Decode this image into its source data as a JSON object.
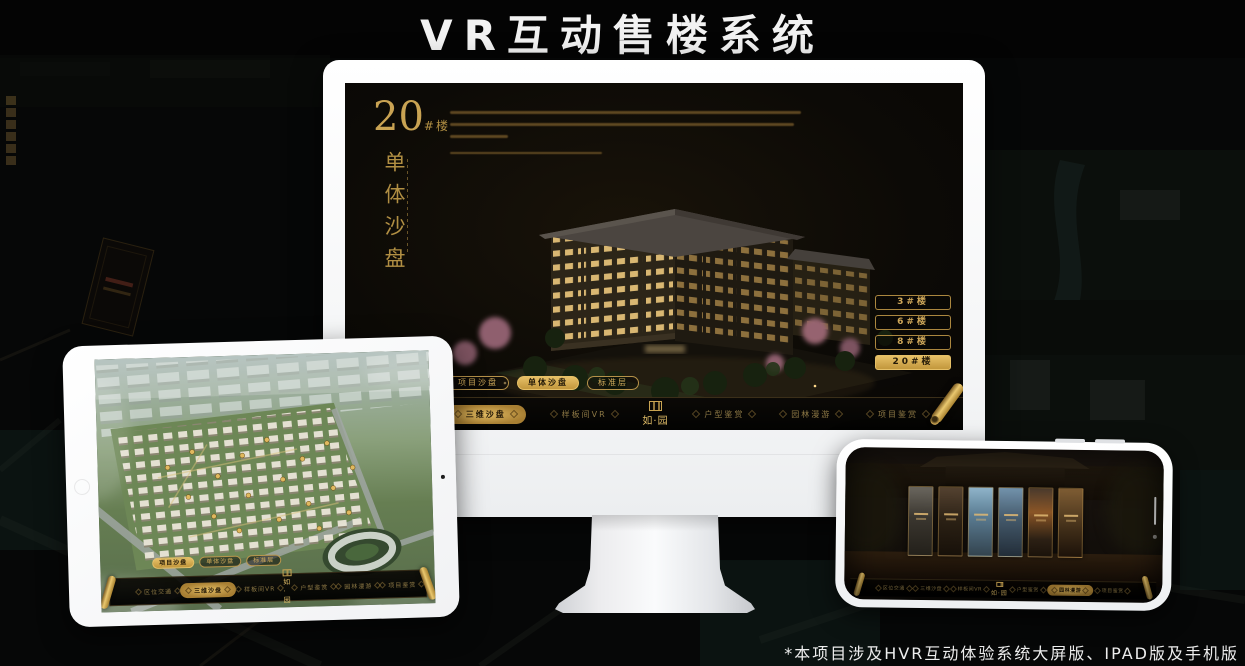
{
  "page": {
    "title": "VR互动售楼系统",
    "footnote": "*本项目涉及HVR互动体验系统大屏版、IPAD版及手机版"
  },
  "colors": {
    "gold": "#c9a353",
    "gold_bright": "#e6c067",
    "screen_bg": "#0c0a06"
  },
  "monitor": {
    "headline_number": "20",
    "headline_suffix": "#楼",
    "headline_vertical": "单体沙盘",
    "floor_buttons": [
      {
        "label": "3#楼",
        "active": false
      },
      {
        "label": "6#楼",
        "active": false
      },
      {
        "label": "8#楼",
        "active": false
      },
      {
        "label": "20#楼",
        "active": true
      }
    ],
    "mode_pills": [
      {
        "label": "项目沙盘",
        "active": false
      },
      {
        "label": "单体沙盘",
        "active": true
      },
      {
        "label": "标准层",
        "active": false
      }
    ],
    "nav": {
      "items": [
        {
          "label": "区位交通",
          "active": false
        },
        {
          "label": "三维沙盘",
          "active": true
        },
        {
          "label": "样板间VR",
          "active": false
        },
        {
          "label": "户型鉴赏",
          "active": false
        },
        {
          "label": "园林漫游",
          "active": false
        },
        {
          "label": "项目鉴赏",
          "active": false
        }
      ],
      "logo": "如·园"
    }
  },
  "tablet": {
    "mode_pills": [
      {
        "label": "项目沙盘",
        "active": true
      },
      {
        "label": "单体沙盘",
        "active": false
      },
      {
        "label": "标准层",
        "active": false
      }
    ],
    "nav": {
      "items": [
        {
          "label": "区位交通",
          "active": false
        },
        {
          "label": "三维沙盘",
          "active": true
        },
        {
          "label": "样板间VR",
          "active": false
        },
        {
          "label": "户型鉴赏",
          "active": false
        },
        {
          "label": "园林漫游",
          "active": false
        },
        {
          "label": "项目鉴赏",
          "active": false
        }
      ],
      "logo": "如·园"
    }
  },
  "phone": {
    "nav": {
      "items": [
        {
          "label": "区位交通",
          "active": false
        },
        {
          "label": "三维沙盘",
          "active": false
        },
        {
          "label": "样板间VR",
          "active": false
        },
        {
          "label": "户型鉴赏",
          "active": false
        },
        {
          "label": "园林漫游",
          "active": true
        },
        {
          "label": "项目鉴赏",
          "active": false
        }
      ],
      "logo": "如·园"
    }
  }
}
